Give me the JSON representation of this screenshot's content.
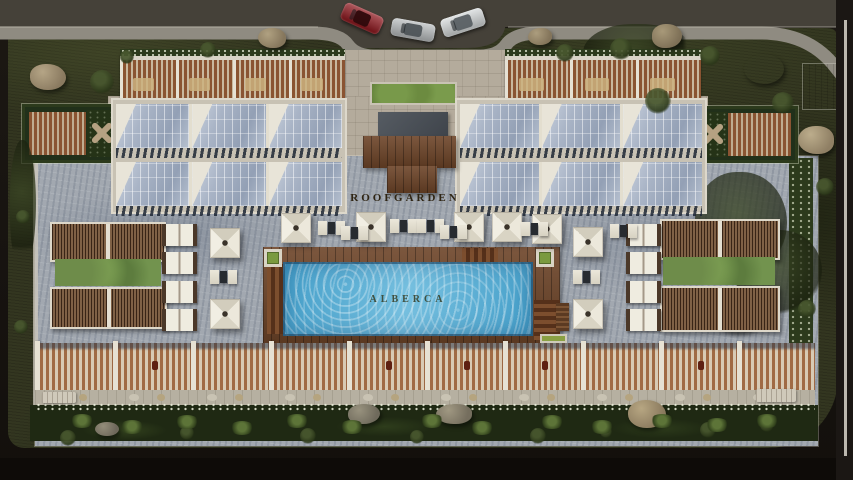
{
  "scene": {
    "description": "Aerial 3D architectural render of a rooftop amenity deck (roof garden) with lap pool, skylights, pergolas, lounge furniture and street parking at top",
    "labels": {
      "roofgarden": "ROOFGARDEN",
      "alberca": "ALBERCA"
    },
    "palette": {
      "road": "#454139",
      "sidewalk": "#8f8b81",
      "lawn": "#333620",
      "paving_light": "#b4ab9c",
      "paving_gray": "#a2a8b0",
      "wood": "#6d4428",
      "glass": "#a9b4c6",
      "water": "#57b1d8",
      "hedge": "#2c3a1c",
      "umbrella": "#eae6d9"
    },
    "cars": [
      {
        "name": "car-red",
        "x": 341,
        "y": 9,
        "w": 42,
        "h": 19,
        "rot": 24,
        "body": "#8c1118",
        "roof": "#2e0a0c"
      },
      {
        "name": "car-silver",
        "x": 391,
        "y": 21,
        "w": 44,
        "h": 18,
        "rot": 10,
        "body": "#b9bdbf",
        "roof": "#4e5458"
      },
      {
        "name": "car-white",
        "x": 441,
        "y": 13,
        "w": 44,
        "h": 19,
        "rot": -18,
        "body": "#d6dadb",
        "roof": "#5a6064"
      }
    ],
    "rocks": [
      {
        "x": 30,
        "y": 64,
        "w": 36,
        "h": 26,
        "base": "#8a7a60",
        "hi": "#b5a586",
        "r": "45% 55% 50% 50%"
      },
      {
        "x": 258,
        "y": 28,
        "w": 28,
        "h": 20,
        "base": "#85765c",
        "hi": "#b0a181",
        "r": "50% 50% 45% 55%"
      },
      {
        "x": 528,
        "y": 28,
        "w": 24,
        "h": 17,
        "base": "#83745a",
        "hi": "#ac9d7e",
        "r": "55% 45% 50% 50%"
      },
      {
        "x": 652,
        "y": 24,
        "w": 30,
        "h": 24,
        "base": "#7d6f56",
        "hi": "#a89979",
        "r": "48% 52% 55% 45%"
      },
      {
        "x": 744,
        "y": 54,
        "w": 40,
        "h": 30,
        "base": "#8a7a60",
        "hi": "#baa browse"
      },
      {
        "x": 798,
        "y": 126,
        "w": 36,
        "h": 28,
        "base": "#8f7f64",
        "hi": "#bcad8c",
        "r": "52% 48% 45% 55%"
      },
      {
        "x": 712,
        "y": 292,
        "w": 52,
        "h": 40,
        "base": "#91815f",
        "hi": "#c2b18a",
        "r": "46% 54% 52% 48%"
      },
      {
        "x": 348,
        "y": 404,
        "w": 32,
        "h": 20,
        "base": "#6f6a5c",
        "hi": "#98927e",
        "r": "50% 50% 55% 45%"
      },
      {
        "x": 436,
        "y": 404,
        "w": 36,
        "h": 20,
        "base": "#756e5e",
        "hi": "#a09882",
        "r": "55% 45% 48% 52%"
      },
      {
        "x": 628,
        "y": 400,
        "w": 38,
        "h": 28,
        "base": "#8a7a5e",
        "hi": "#b7a682",
        "r": "47% 53% 50% 50%"
      },
      {
        "x": 95,
        "y": 422,
        "w": 24,
        "h": 14,
        "base": "#6d675a",
        "hi": "#948d7a",
        "r": "50% 50% 50% 50%"
      }
    ],
    "bushes": [
      {
        "x": 90,
        "y": 70,
        "s": 24
      },
      {
        "x": 200,
        "y": 42,
        "s": 16
      },
      {
        "x": 120,
        "y": 50,
        "s": 14
      },
      {
        "x": 556,
        "y": 44,
        "s": 18
      },
      {
        "x": 610,
        "y": 38,
        "s": 22
      },
      {
        "x": 645,
        "y": 88,
        "s": 26
      },
      {
        "x": 700,
        "y": 46,
        "s": 20
      },
      {
        "x": 772,
        "y": 92,
        "s": 22
      },
      {
        "x": 816,
        "y": 178,
        "s": 18
      },
      {
        "x": 750,
        "y": 248,
        "s": 22
      },
      {
        "x": 798,
        "y": 300,
        "s": 18
      },
      {
        "x": 16,
        "y": 210,
        "s": 14
      },
      {
        "x": 14,
        "y": 320,
        "s": 14
      },
      {
        "x": 60,
        "y": 430,
        "s": 16
      },
      {
        "x": 180,
        "y": 426,
        "s": 14
      },
      {
        "x": 300,
        "y": 428,
        "s": 16
      },
      {
        "x": 410,
        "y": 430,
        "s": 14
      },
      {
        "x": 530,
        "y": 428,
        "s": 16
      },
      {
        "x": 600,
        "y": 426,
        "s": 12
      },
      {
        "x": 700,
        "y": 422,
        "s": 16
      },
      {
        "x": 760,
        "y": 418,
        "s": 14
      }
    ],
    "trees": [
      {
        "x": 583,
        "y": 24,
        "w": 112,
        "h": 64
      },
      {
        "x": 695,
        "y": 172,
        "w": 92,
        "h": 104
      },
      {
        "x": 736,
        "y": 230,
        "w": 86,
        "h": 84
      },
      {
        "x": 10,
        "y": 140,
        "w": 26,
        "h": 130
      }
    ],
    "ferns": [
      {
        "x": 70,
        "y": 414
      },
      {
        "x": 120,
        "y": 420
      },
      {
        "x": 175,
        "y": 415
      },
      {
        "x": 230,
        "y": 421
      },
      {
        "x": 285,
        "y": 414
      },
      {
        "x": 340,
        "y": 420
      },
      {
        "x": 420,
        "y": 414
      },
      {
        "x": 470,
        "y": 421
      },
      {
        "x": 540,
        "y": 415
      },
      {
        "x": 590,
        "y": 420
      },
      {
        "x": 650,
        "y": 414
      },
      {
        "x": 705,
        "y": 418
      },
      {
        "x": 755,
        "y": 414
      }
    ],
    "terrace_groups": [
      {
        "x": 120,
        "y": 54,
        "w": 225,
        "h": 46,
        "bays": 4
      },
      {
        "x": 505,
        "y": 54,
        "w": 196,
        "h": 46,
        "bays": 3
      }
    ],
    "glass_blocks": [
      {
        "x": 113,
        "y": 100,
        "w": 232,
        "h": 112,
        "panels": 3
      },
      {
        "x": 457,
        "y": 100,
        "w": 248,
        "h": 112,
        "panels": 3
      }
    ],
    "pergolas": [
      {
        "x": 50,
        "y": 222,
        "w": 112,
        "h": 36
      },
      {
        "x": 50,
        "y": 287,
        "w": 113,
        "h": 38
      },
      {
        "x": 660,
        "y": 219,
        "w": 116,
        "h": 37
      },
      {
        "x": 660,
        "y": 286,
        "w": 116,
        "h": 42
      }
    ],
    "plant_bands": [
      {
        "x": 55,
        "y": 259,
        "w": 106,
        "h": 27
      },
      {
        "x": 663,
        "y": 257,
        "w": 112,
        "h": 28
      }
    ],
    "cabanas": {
      "w": 27,
      "h": 22,
      "items": [
        {
          "x": 162,
          "y": 224
        },
        {
          "x": 162,
          "y": 252
        },
        {
          "x": 162,
          "y": 281
        },
        {
          "x": 162,
          "y": 309
        },
        {
          "x": 626,
          "y": 224
        },
        {
          "x": 626,
          "y": 252
        },
        {
          "x": 626,
          "y": 281
        },
        {
          "x": 626,
          "y": 309
        }
      ]
    },
    "umbrellas": [
      {
        "x": 281,
        "y": 213
      },
      {
        "x": 356,
        "y": 212
      },
      {
        "x": 454,
        "y": 212
      },
      {
        "x": 492,
        "y": 212
      },
      {
        "x": 532,
        "y": 214
      },
      {
        "x": 210,
        "y": 228
      },
      {
        "x": 210,
        "y": 299
      },
      {
        "x": 573,
        "y": 227
      },
      {
        "x": 573,
        "y": 299
      }
    ],
    "seat_clusters": [
      {
        "x": 318,
        "y": 219
      },
      {
        "x": 341,
        "y": 224
      },
      {
        "x": 390,
        "y": 217
      },
      {
        "x": 417,
        "y": 217
      },
      {
        "x": 440,
        "y": 223
      },
      {
        "x": 521,
        "y": 220
      },
      {
        "x": 610,
        "y": 222
      },
      {
        "x": 210,
        "y": 268
      },
      {
        "x": 573,
        "y": 268
      }
    ],
    "bottom_bays": {
      "x": 35,
      "y": 343,
      "h": 47,
      "count": 10,
      "bay_w": 73,
      "divider_w": 5,
      "embers": [
        1,
        4,
        5,
        6,
        8
      ]
    },
    "benches": [
      {
        "x": 42,
        "y": 392,
        "w": 34,
        "h": 11
      },
      {
        "x": 756,
        "y": 389,
        "w": 40,
        "h": 13
      }
    ],
    "wood_benches": [
      {
        "x": 556,
        "y": 303,
        "w": 13,
        "h": 28
      }
    ]
  }
}
